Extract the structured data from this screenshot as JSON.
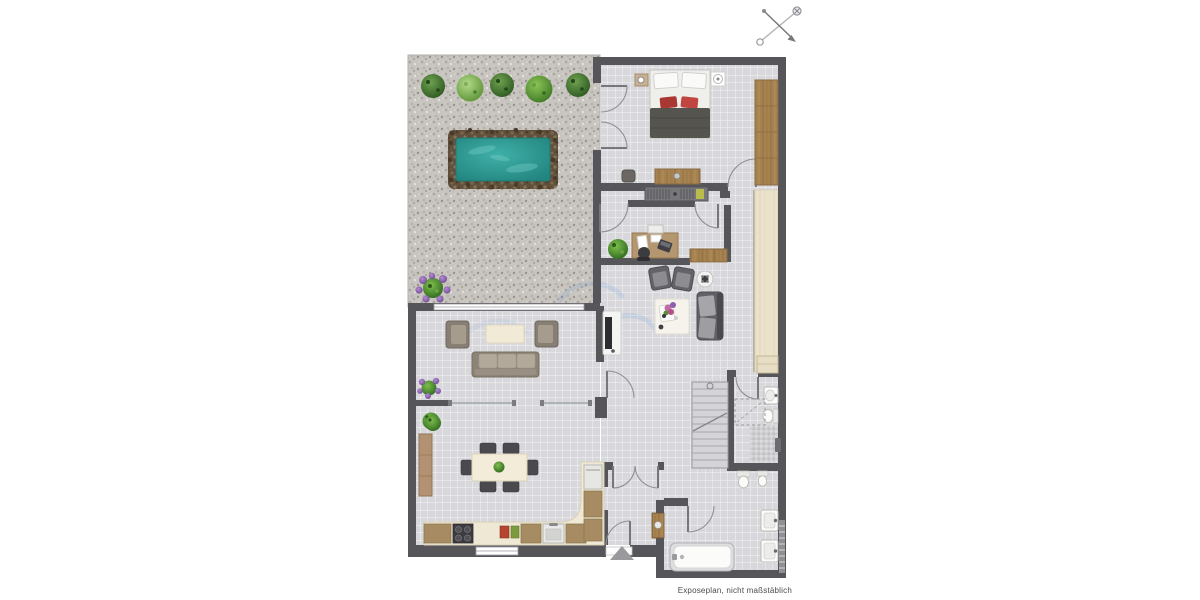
{
  "footer": {
    "note": "Exposeplan, nicht maßstäblich"
  },
  "compass": {
    "icon": "compass-north-arrow"
  },
  "palette": {
    "wall": "#55555a",
    "floor_tile": "#d8d8dc",
    "gravel": "#c8c4bf",
    "pool_water": "#2c9a93",
    "pool_border": "#60503c",
    "wood_dark": "#a5824f",
    "wood_light": "#ebe2cb",
    "counter_cream": "#efe8d4",
    "sofa_taupe": "#8d8478",
    "sofa_dark": "#63636a",
    "accent_red": "#ab3732",
    "plant_green": "#4e8a2e",
    "plant_purple": "#8b5fb0"
  },
  "floorplan": {
    "garden": {
      "items": [
        "bush-dark",
        "bush-light",
        "bush-dark",
        "bush-mid",
        "bush-dark",
        "pool",
        "purple-flower-bush"
      ]
    },
    "rooms": [
      {
        "name": "bedroom",
        "furniture": [
          "double-bed",
          "red-pillows",
          "nightstand-lamp-left",
          "nightstand-lamp-right",
          "wardrobe",
          "dresser",
          "stool"
        ]
      },
      {
        "name": "closet-corridor",
        "furniture": [
          "built-in-wardrobe"
        ]
      },
      {
        "name": "office",
        "furniture": [
          "desk",
          "office-chair",
          "laptop",
          "printer",
          "plant",
          "lowboard"
        ]
      },
      {
        "name": "lounge-hall",
        "furniture": [
          "armchair",
          "armchair",
          "round-side-table",
          "sofa-dark",
          "rug-with-flowers",
          "tv-lowboard",
          "wood-floor-strip"
        ]
      },
      {
        "name": "living-room",
        "furniture": [
          "armchair",
          "armchair",
          "coffee-table",
          "sofa",
          "purple-plant",
          "green-plant"
        ]
      },
      {
        "name": "dining-room",
        "furniture": [
          "dining-table",
          "dining-chairs-x6",
          "table-plant",
          "sideboard",
          "green-plant"
        ]
      },
      {
        "name": "kitchen",
        "furniture": [
          "l-shaped-counter",
          "cooktop",
          "sink",
          "cutting-boards",
          "oven"
        ]
      },
      {
        "name": "stairwell",
        "furniture": [
          "staircase"
        ]
      },
      {
        "name": "bathroom-upper",
        "furniture": [
          "washbasin",
          "toilet",
          "shower-dashed",
          "mosaic-floor",
          "cabinet"
        ]
      },
      {
        "name": "bathroom-lower",
        "furniture": [
          "bathtub",
          "washbasin",
          "washbasin",
          "toilet",
          "bidet",
          "towel-radiator",
          "vanity"
        ]
      },
      {
        "name": "entry",
        "furniture": [
          "entrance-arrow",
          "double-swing-doors"
        ]
      }
    ]
  }
}
